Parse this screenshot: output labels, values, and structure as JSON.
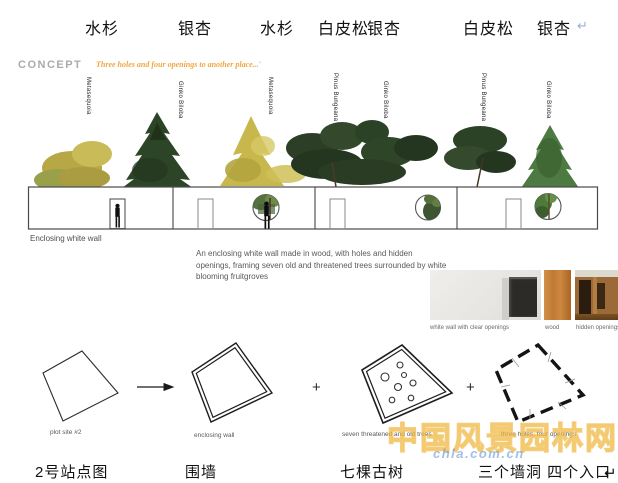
{
  "top_species_labels": [
    {
      "text": "水杉"
    },
    {
      "text": "银杏"
    },
    {
      "text": "水杉"
    },
    {
      "text": "白皮松"
    },
    {
      "text": "银杏"
    },
    {
      "text": "白皮松"
    },
    {
      "text": "银杏"
    }
  ],
  "return_mark": "↵",
  "concept": {
    "heading": "CONCEPT",
    "quote": "Three holes and four openings to another place...'"
  },
  "tree_labels": [
    "Metasequoia",
    "Ginko Biloba",
    "Metasequoia",
    "Pinus Bungeana",
    "Ginko Biloba",
    "Pinus Bungeana",
    "Ginko Biloba"
  ],
  "wall": {
    "caption": "Enclosing white wall"
  },
  "description": "An enclosing white wall made in wood, with holes and hidden openings, framing seven old and threatened trees surrounded by white blooming fruitgroves",
  "materials": {
    "captions": [
      "white wall with clear openings",
      "wood",
      "hidden openings"
    ]
  },
  "process": {
    "arrow": "→",
    "plus": "+",
    "steps": [
      {
        "caption_en": "plot site #2",
        "caption_zh": "2号站点图"
      },
      {
        "caption_en": "enclosing wall",
        "caption_zh": "围墙"
      },
      {
        "caption_en": "seven threatened and old trees",
        "caption_zh": "七棵古树"
      },
      {
        "caption_en": "three holes, four openings",
        "caption_zh": "三个墙洞  四个入口"
      }
    ]
  },
  "watermark": {
    "text": "中国风景园林网",
    "url": "chla.com.cn"
  },
  "colors": {
    "accent_orange": "#f0a73e",
    "concept_gray": "#ababab",
    "body_gray": "#595959",
    "wood": "#c07a35"
  }
}
